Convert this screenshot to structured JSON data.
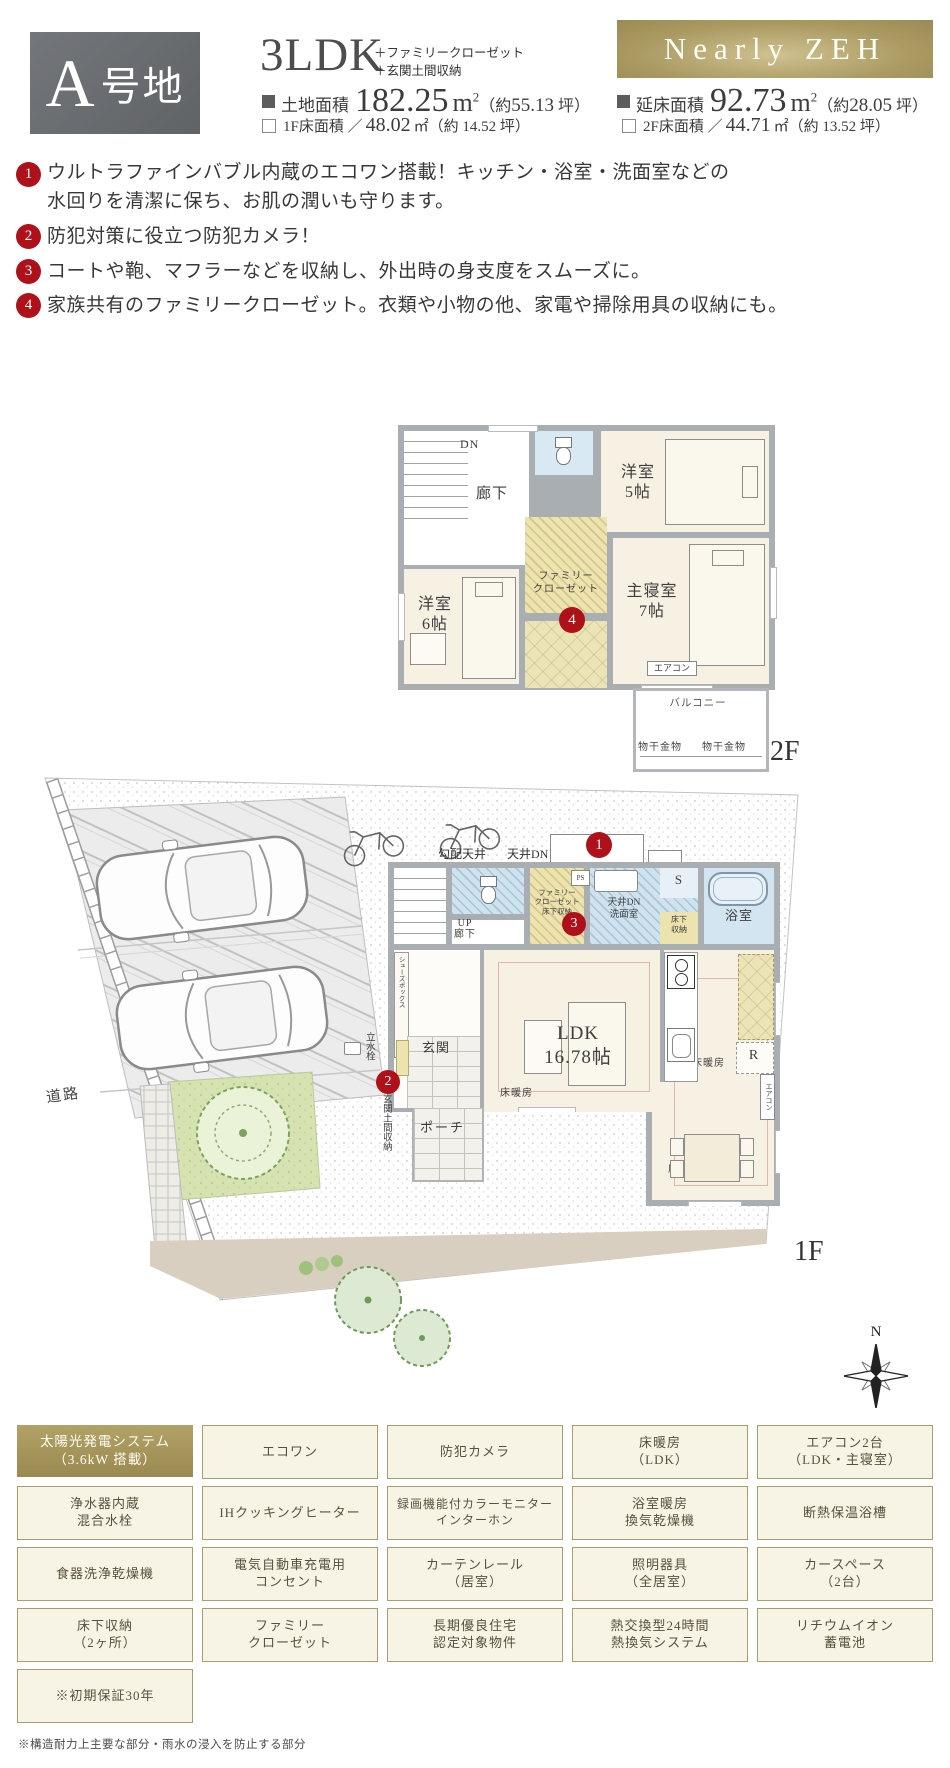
{
  "header": {
    "plot_badge": {
      "letter": "A",
      "suffix": "号地"
    },
    "layout": "3LDK",
    "layout_plus_1": "＋ファミリークローゼット",
    "layout_plus_2": "＋玄関土間収納",
    "zeh_badge": "Nearly ZEH",
    "land": {
      "label": "土地面積",
      "value": "182.25",
      "unit_base": "m",
      "unit_sup": "2",
      "tsubo_pre": "（約",
      "tsubo_num": "55.13",
      "tsubo_suf": " 坪）"
    },
    "total": {
      "label": "延床面積",
      "value": "92.73",
      "unit_base": "m",
      "unit_sup": "2",
      "tsubo_pre": "（約",
      "tsubo_num": "28.05",
      "tsubo_suf": " 坪）"
    },
    "floor1": {
      "label": "1F床面積 ／",
      "value": "48.02",
      "unit": "㎡",
      "tsubo": "（約 14.52 坪）"
    },
    "floor2": {
      "label": "2F床面積 ／",
      "value": "44.71",
      "unit": "㎡",
      "tsubo": "（約 13.52 坪）"
    }
  },
  "features": [
    {
      "num": "1",
      "text": "ウルトラファインバブル内蔵のエコワン搭載！キッチン・浴室・洗面室などの\n水回りを清潔に保ち、お肌の潤いも守ります。"
    },
    {
      "num": "2",
      "text": "防犯対策に役立つ防犯カメラ！"
    },
    {
      "num": "3",
      "text": "コートや鞄、マフラーなどを収納し、外出時の身支度をスムーズに。"
    },
    {
      "num": "4",
      "text": "家族共有のファミリークローゼット。衣類や小物の他、家電や掃除用具の収納にも。"
    }
  ],
  "plan2f": {
    "floor_label": "2F",
    "dn": "DN",
    "hallway": "廊下",
    "room5": "洋室\n5帖",
    "room6": "洋室\n6帖",
    "fc": "ファミリー\nクローゼット",
    "badge4": "4",
    "master": "主寝室\n7帖",
    "aircon": "エアコン",
    "balcony": "バルコニー",
    "hanger1": "物干金物",
    "hanger2": "物干金物"
  },
  "plan1f": {
    "floor_label": "1F",
    "slope_ceiling": "勾配天井",
    "ceiling_dn": "天井DN",
    "badge1": "1",
    "up_hall": "UP\n廊下",
    "ps": "PS",
    "fc": "ファミリー\nクローゼット\n床下収納",
    "badge3": "3",
    "washroom": "天井DN\n洗面室",
    "s_closet": "S",
    "underfloor": "床下\n収納",
    "bath": "浴室",
    "shoes_box": "シューズボックス",
    "hall": "ホール",
    "entrance": "玄関",
    "ldk": "LDK\n16.78帖",
    "floorheat1": "床暖房",
    "floorheat2": "床暖房",
    "floorheat3": "床暖房",
    "fridge": "R",
    "aircon": "エアコン",
    "porch": "ポーチ",
    "badge2": "2",
    "faucet": "立水栓",
    "doma": "玄関土間収納",
    "road": "道路",
    "north": "N"
  },
  "equipment": {
    "items": [
      {
        "label": "太陽光発電システム\n（3.6kW 搭載）",
        "highlight": true
      },
      {
        "label": "エコワン"
      },
      {
        "label": "防犯カメラ"
      },
      {
        "label": "床暖房\n（LDK）"
      },
      {
        "label": "エアコン2台\n（LDK・主寝室）"
      },
      {
        "label": "浄水器内蔵\n混合水栓"
      },
      {
        "label": "IHクッキングヒーター"
      },
      {
        "label": "録画機能付カラーモニター\nインターホン"
      },
      {
        "label": "浴室暖房\n換気乾燥機"
      },
      {
        "label": "断熱保温浴槽"
      },
      {
        "label": "食器洗浄乾燥機"
      },
      {
        "label": "電気自動車充電用\nコンセント"
      },
      {
        "label": "カーテンレール\n（居室）"
      },
      {
        "label": "照明器具\n（全居室）"
      },
      {
        "label": "カースペース\n（2台）"
      },
      {
        "label": "床下収納\n（2ヶ所）"
      },
      {
        "label": "ファミリー\nクローゼット"
      },
      {
        "label": "長期優良住宅\n認定対象物件"
      },
      {
        "label": "熱交換型24時間\n熱換気システム"
      },
      {
        "label": "リチウムイオン\n蓄電池"
      },
      {
        "label": "※初期保証30年"
      }
    ]
  },
  "notes": {
    "bottom": "※構造耐力上主要な部分・雨水の浸入を防止する部分"
  }
}
